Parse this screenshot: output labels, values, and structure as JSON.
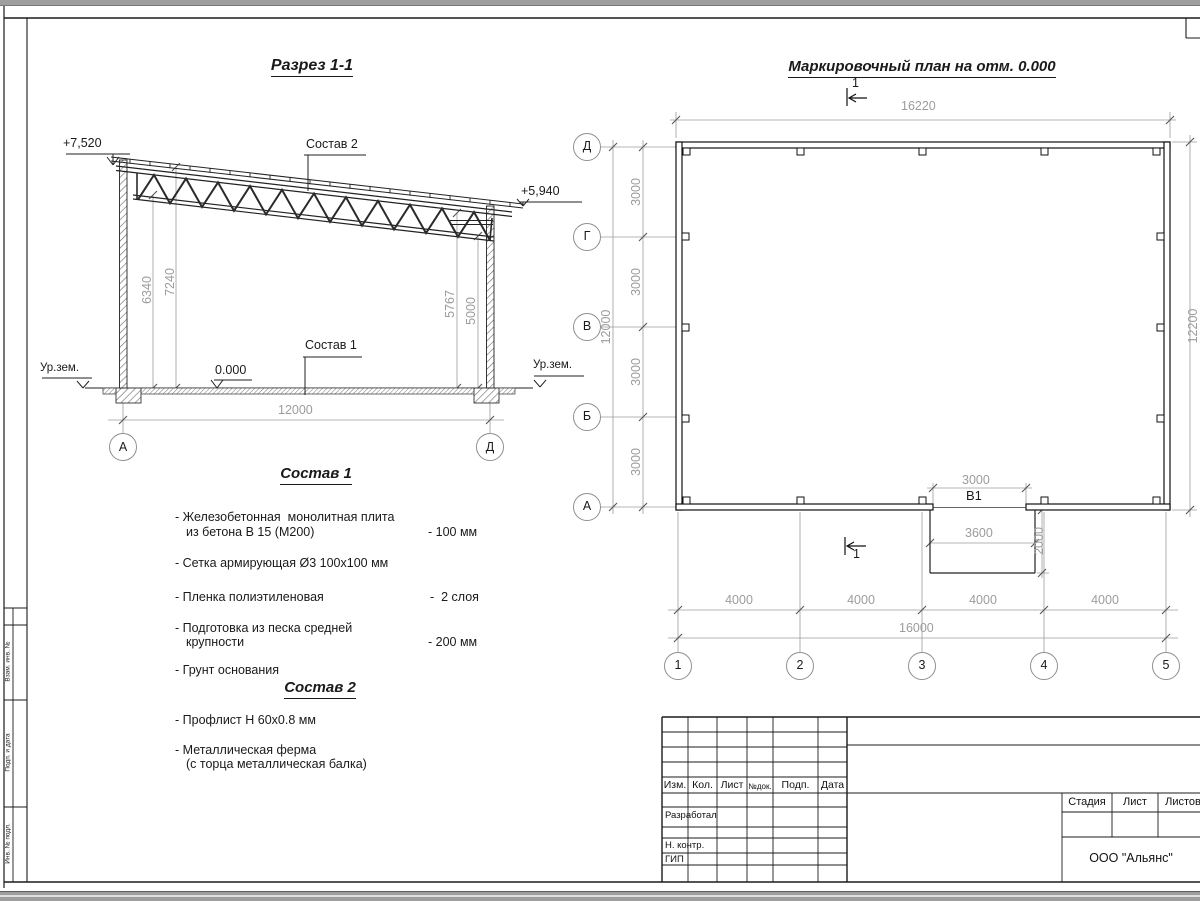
{
  "section": {
    "title": "Разрез 1-1",
    "elev_left": "+7,520",
    "elev_right": "+5,940",
    "ref2": "Состав 2",
    "ref1": "Состав 1",
    "zero": "0.000",
    "ground": "Ур.зем.",
    "dim1": "6340",
    "dim2": "7240",
    "dim3": "5767",
    "dim4": "5000",
    "span": "12000",
    "axis_left": "А",
    "axis_right": "Д"
  },
  "sostav1": {
    "title": "Состав 1",
    "items": [
      {
        "l1": "- Железобетонная  монолитная плита",
        "l2": "из бетона В 15 (М200)",
        "val": "- 100 мм"
      },
      {
        "l1": "- Сетка армирующая Ø3 100х100 мм",
        "l2": "",
        "val": ""
      },
      {
        "l1": "- Пленка полиэтиленовая",
        "l2": "",
        "val": "-  2 слоя"
      },
      {
        "l1": "- Подготовка из песка средней",
        "l2": "крупности",
        "val": "- 200 мм"
      },
      {
        "l1": "- Грунт основания",
        "l2": "",
        "val": ""
      }
    ]
  },
  "sostav2": {
    "title": "Состав 2",
    "items": [
      {
        "l1": "- Профлист Н 60х0.8 мм",
        "l2": ""
      },
      {
        "l1": "- Металлическая ферма",
        "l2": "(с торца металлическая балка)"
      }
    ]
  },
  "plan": {
    "title": "Маркировочный план на отм. 0.000",
    "cut": "1",
    "top": "16220",
    "right": "12200",
    "left_total": "12000",
    "s3000": [
      "3000",
      "3000",
      "3000",
      "3000"
    ],
    "door": "В1",
    "door_dim": "3000",
    "ramp_w": "3600",
    "ramp_d": "2000",
    "s4000": [
      "4000",
      "4000",
      "4000",
      "4000"
    ],
    "bottom_total": "16000",
    "rows": [
      "Д",
      "Г",
      "В",
      "Б",
      "А"
    ],
    "cols": [
      "1",
      "2",
      "3",
      "4",
      "5"
    ]
  },
  "titleblock": {
    "cols": [
      "Изм.",
      "Кол.",
      "Лист",
      "№док.",
      "Подп.",
      "Дата"
    ],
    "roles": [
      "Разработал",
      "Н. контр.",
      "ГИП"
    ],
    "stage": [
      "Стадия",
      "Лист",
      "Листов"
    ],
    "company": "ООО \"Альянс\""
  },
  "frame": {
    "side_labels": [
      "Взам. инв. №",
      "Подп. и дата",
      "Инв. № подл."
    ]
  }
}
